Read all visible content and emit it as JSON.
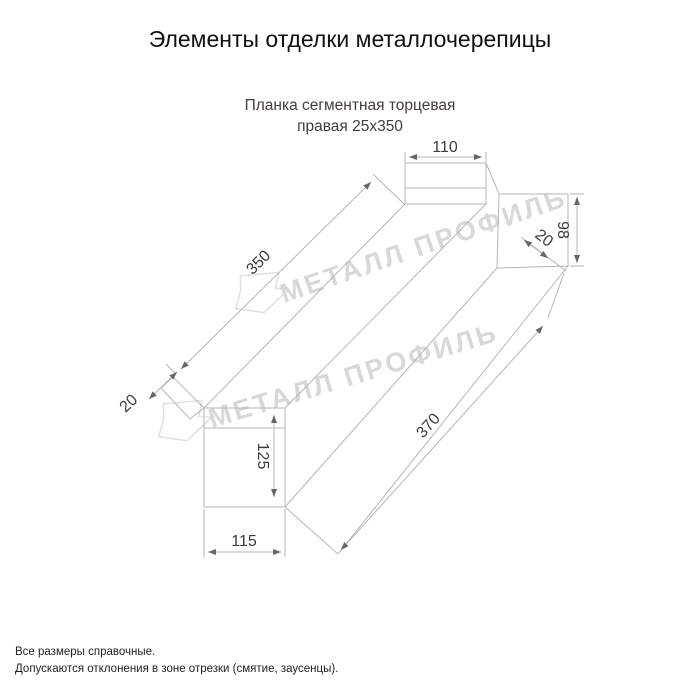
{
  "header": {
    "title": "Элементы отделки металлочерепицы"
  },
  "product": {
    "subtitle_line1": "Планка сегментная торцевая",
    "subtitle_line2": "правая 25х350"
  },
  "drawing": {
    "dimensions": {
      "top_width": "110",
      "right_height": "98",
      "right_fold": "20",
      "top_length": "350",
      "left_tab": "20",
      "bottom_height": "125",
      "bottom_width": "115",
      "bottom_length": "370"
    },
    "watermark_text": "МЕТАЛЛ ПРОФИЛЬ",
    "colors": {
      "line": "#b3b6b8",
      "dimension_text": "#3c3c3c",
      "arrow": "#666666",
      "watermark": "#d7d8d9",
      "watermark_logo": "#dfe0e0"
    }
  },
  "footer": {
    "note1": "Все размеры справочные.",
    "note2": "Допускаются отклонения в зоне отрезки (смятие, заусенцы)."
  }
}
